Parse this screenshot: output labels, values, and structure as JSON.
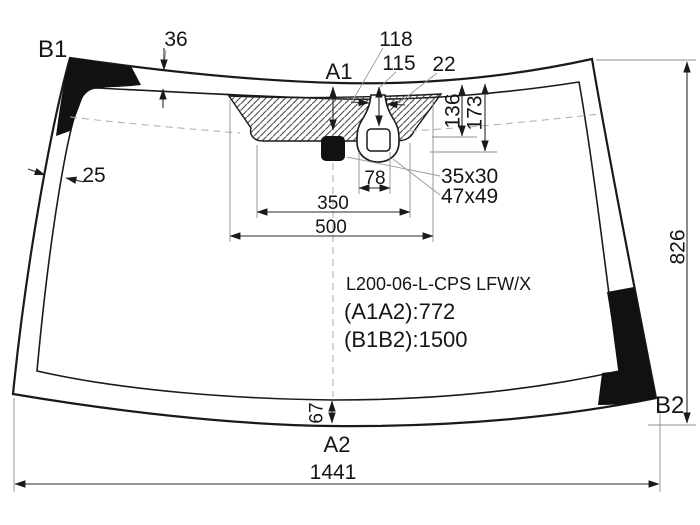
{
  "diagram": {
    "part_label": "L200-06-L-CPS LFW/X",
    "dim_a1a2": "(A1A2):772",
    "dim_b1b2": "(B1B2):1500",
    "corner_top_left": "B1",
    "corner_bottom_right": "B2",
    "axis_top": "A1",
    "axis_bottom": "A2",
    "dims": {
      "top_band_width": "36",
      "side_band_width": "25",
      "sensor_offset_a": "118",
      "sensor_offset_b": "115",
      "sensor_neck_width": "22",
      "band_depth_1": "136",
      "band_depth_2": "173",
      "sensor_width": "78",
      "mount_span": "350",
      "band_span": "500",
      "mirror_size": "35x30",
      "sensor_size": "47x49",
      "glass_height": "826",
      "bottom_band_width": "67",
      "glass_width": "1441"
    }
  },
  "colors": {
    "line": "#1a1a1a",
    "dimension": "#2a2a2a",
    "ceramic_black": "#111111",
    "background": "#ffffff"
  }
}
